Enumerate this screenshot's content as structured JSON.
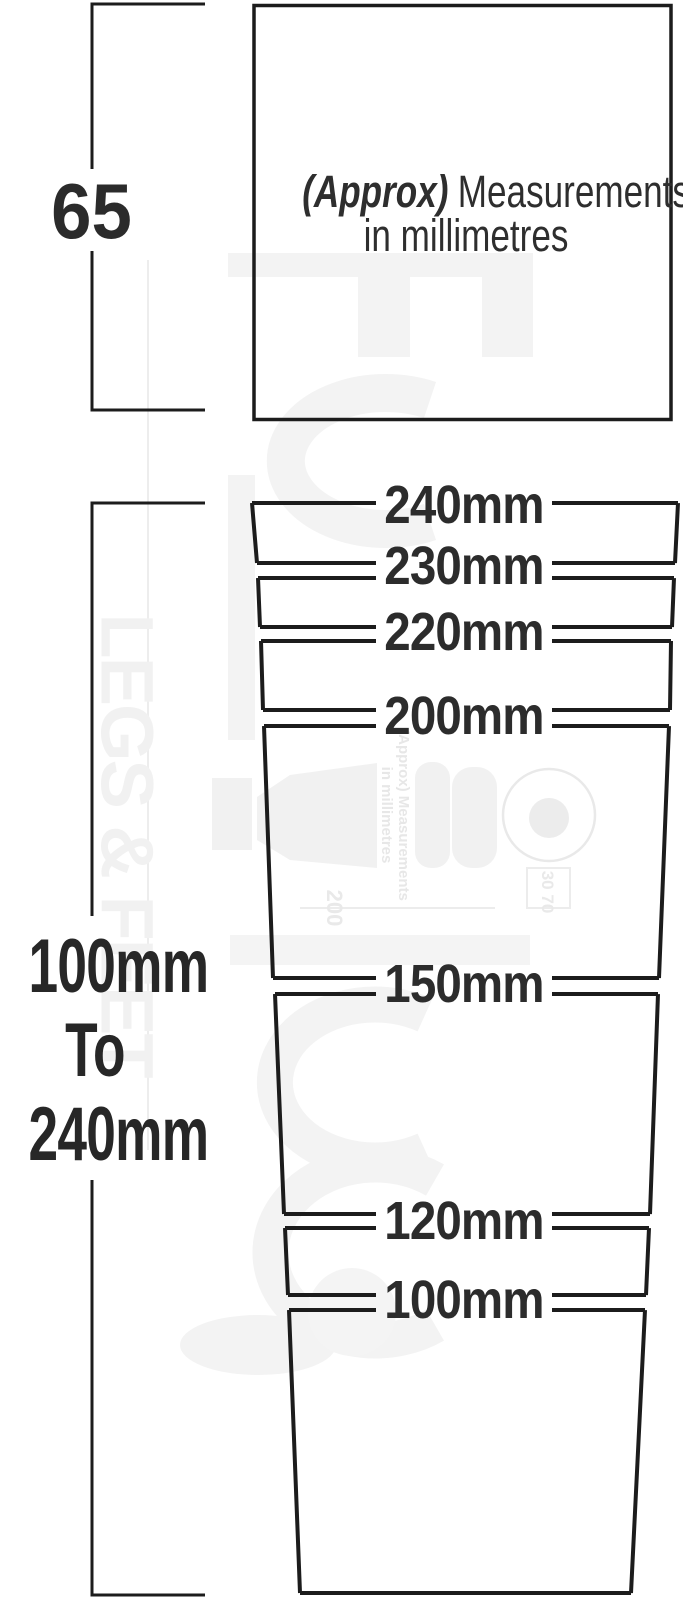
{
  "title_box": {
    "approx": "(Approx)",
    "measurements": "Measurements",
    "line2": "in millimetres"
  },
  "left_dimensions": {
    "top_height": "65",
    "range": [
      "100mm",
      "To",
      "240mm"
    ]
  },
  "size_labels": [
    "240mm",
    "230mm",
    "220mm",
    "200mm",
    "150mm",
    "120mm",
    "100mm"
  ],
  "watermark": {
    "vertical_brand": "LEGS & FEET",
    "note_line1": "(Approx) Measurements",
    "note_line2": "in millimetres",
    "dim_a": "200",
    "dim_b": "30 70"
  },
  "colors": {
    "line": "#1c1c1c",
    "text": "#2b2b2b",
    "watermark_light": "#f3f3f3",
    "watermark_mid": "#e9e9e9",
    "background": "#ffffff"
  }
}
